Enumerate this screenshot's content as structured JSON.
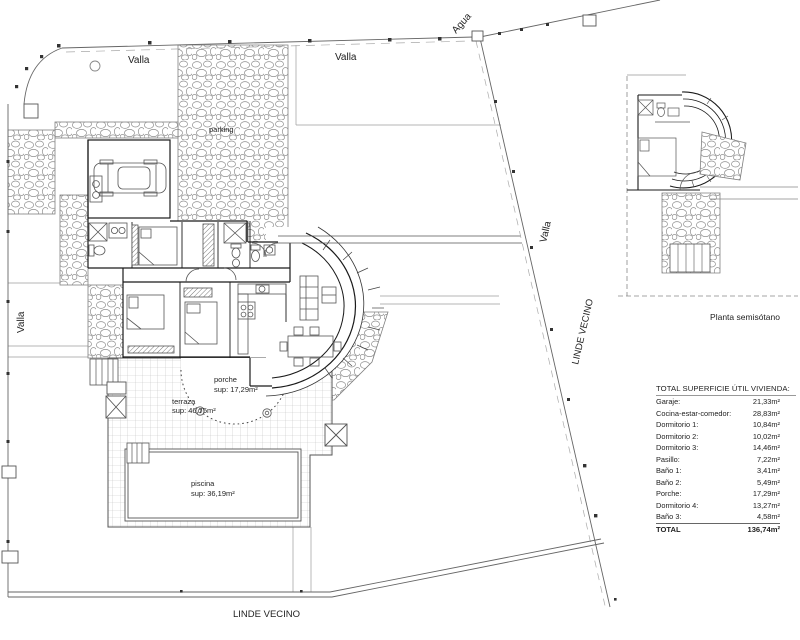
{
  "labels": {
    "agua": "Agua",
    "valla_top_left": "Valla",
    "valla_top_mid": "Valla",
    "valla_left": "Valla",
    "valla_right": "Valla",
    "parking": "parking",
    "linde_right": "LINDE VECINO",
    "linde_bottom": "LINDE VECINO",
    "planta": "Planta semisótano"
  },
  "areas": {
    "porche": {
      "name": "porche",
      "sup": "sup: 17,29m²"
    },
    "terraza": {
      "name": "terraza",
      "sup": "sup: 46,75m²"
    },
    "piscina": {
      "name": "piscina",
      "sup": "sup: 36,19m²"
    }
  },
  "table": {
    "title": "TOTAL SUPERFICIE ÚTIL VIVIENDA:",
    "rows": [
      {
        "label": "Garaje:",
        "value": "21,33m²"
      },
      {
        "label": "Cocina-estar-comedor:",
        "value": "28,83m²"
      },
      {
        "label": "Dormitorio 1:",
        "value": "10,84m²"
      },
      {
        "label": "Dormitorio 2:",
        "value": "10,02m²"
      },
      {
        "label": "Dormitorio 3:",
        "value": "14,46m²"
      },
      {
        "label": "Pasillo:",
        "value": "7,22m²"
      },
      {
        "label": "Baño 1:",
        "value": "3,41m²"
      },
      {
        "label": "Baño 2:",
        "value": "5,49m²"
      },
      {
        "label": "Porche:",
        "value": "17,29m²"
      },
      {
        "label": "Dormitorio 4:",
        "value": "13,27m²"
      },
      {
        "label": "Baño 3:",
        "value": "4,58m²"
      }
    ],
    "total": {
      "label": "TOTAL",
      "value": "136,74m²"
    }
  }
}
